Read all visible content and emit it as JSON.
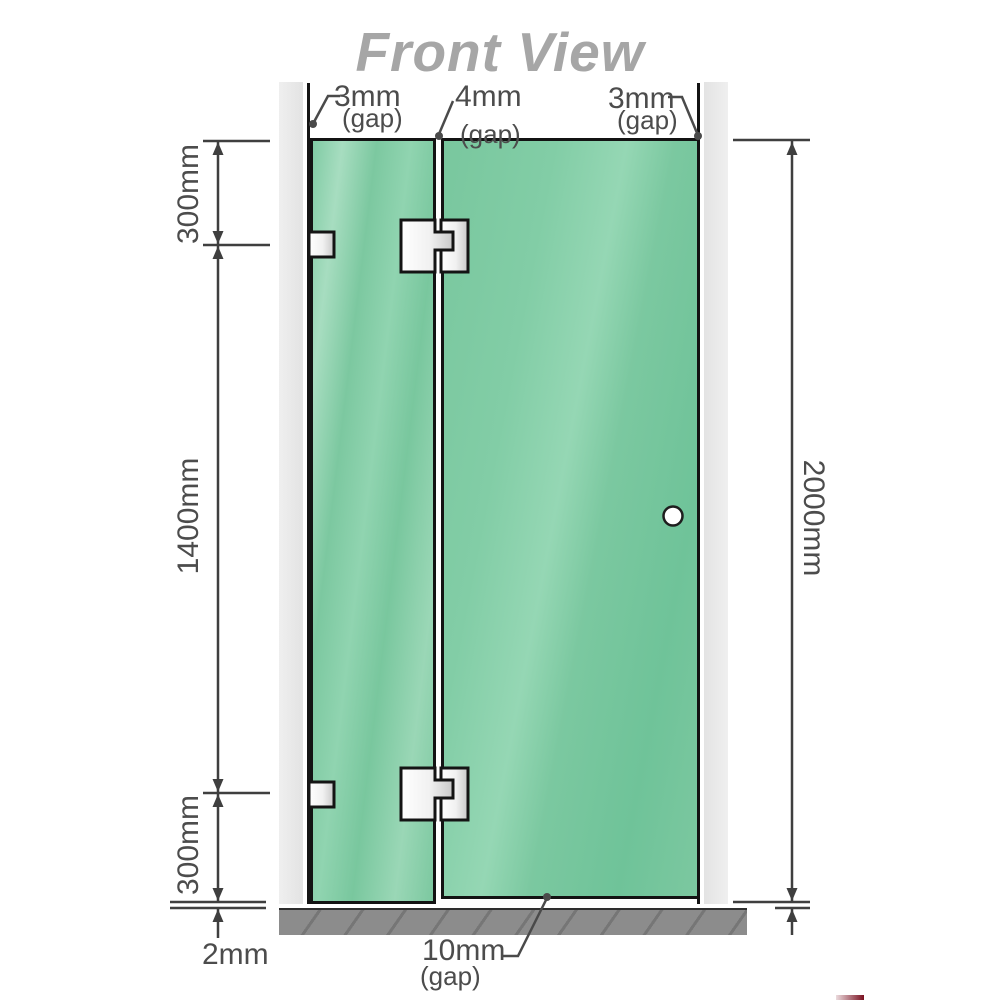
{
  "title": "Front View",
  "labels": {
    "top_gaps": [
      {
        "value": "3mm",
        "unit": "(gap)"
      },
      {
        "value": "4mm",
        "unit": "(gap)"
      },
      {
        "value": "3mm",
        "unit": "(gap)"
      }
    ],
    "left_dims": {
      "top": "300mm",
      "middle": "1400mm",
      "bottom": "300mm",
      "floor_gap": "2mm"
    },
    "right_dim": {
      "height": "2000mm"
    },
    "bottom_gap": {
      "value": "10mm",
      "unit": "(gap)"
    }
  },
  "colors": {
    "glass_green": "#7cc8a0",
    "glass_green_light": "#9bd9b8",
    "wall_gray": "#e9e9e9",
    "floor_gray": "#8c8c8c",
    "outline_dark": "#141414",
    "dimension_gray": "#4c4c4c",
    "title_gray": "#a6a6a6",
    "hardware_white": "#ffffff"
  }
}
